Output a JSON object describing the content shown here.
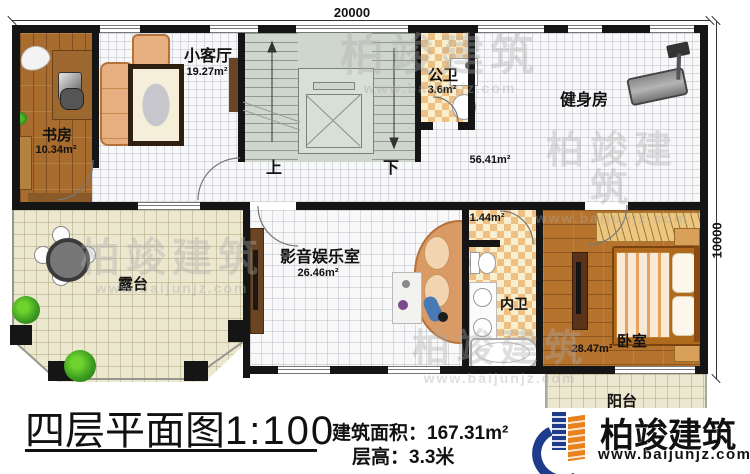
{
  "dimensions": {
    "top": "20000",
    "right": "10000"
  },
  "rooms": {
    "study": {
      "name": "书房",
      "area": "10.34m²"
    },
    "small_living": {
      "name": "小客厅",
      "area": "19.27m²"
    },
    "public_bath": {
      "name": "公卫",
      "area": "3.6m²"
    },
    "gym": {
      "name": "健身房",
      "area": "56.41m²"
    },
    "terrace": {
      "name": "露台"
    },
    "media_room": {
      "name": "影音娱乐室",
      "area": "26.46m²"
    },
    "closet": {
      "area": "1.44m²"
    },
    "inner_bath": {
      "name": "内卫"
    },
    "bedroom": {
      "name": "卧室",
      "area": "28.47m²"
    },
    "balcony": {
      "name": "阳台"
    }
  },
  "stairs": {
    "up_label": "上",
    "down_label": "下"
  },
  "footer": {
    "title": "四层平面图",
    "scale": "1:100",
    "area_label": "建筑面积：",
    "area_value": "167.31m²",
    "height_label": "层高：",
    "height_value": "3.3米"
  },
  "logo": {
    "name": "柏竣建筑",
    "url": "www.baijunjz.com"
  },
  "watermark": {
    "text": "柏竣建筑",
    "url": "www.baijunjz.com"
  },
  "colors": {
    "wall": "#151515",
    "stair_floor": "#cfd7cd",
    "study_wood": "#a86c2e",
    "bedroom_wood": "#b5732e",
    "bath_checker": "#efc083",
    "terrace_cream": "#ece7cf",
    "logo_blue": "#1e3c8c",
    "logo_orange": "#e8821e"
  }
}
